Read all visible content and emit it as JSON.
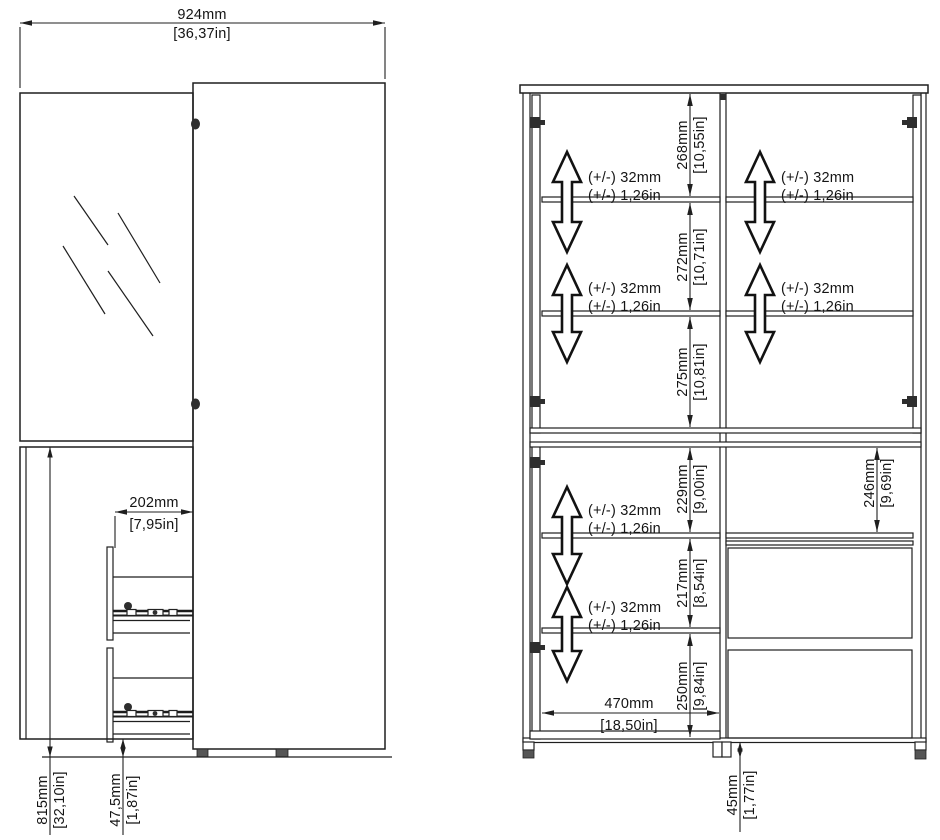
{
  "page": {
    "background": "#ffffff",
    "line_color": "#1f1f1f"
  },
  "front_view": {
    "width": {
      "mm": "924mm",
      "in": "[36,37in]"
    },
    "drawer_depth": {
      "mm": "202mm",
      "in": "[7,95in]"
    },
    "lower_section_height": {
      "mm": "815mm",
      "in": "[32,10in]"
    },
    "plinth_height": {
      "mm": "47,5mm",
      "in": "[1,87in]"
    }
  },
  "interior_view": {
    "section_heights": [
      {
        "mm": "268mm",
        "in": "[10,55in]"
      },
      {
        "mm": "272mm",
        "in": "[10,71in]"
      },
      {
        "mm": "275mm",
        "in": "[10,81in]"
      },
      {
        "mm": "229mm",
        "in": "[9,00in]"
      },
      {
        "mm": "217mm",
        "in": "[8,54in]"
      },
      {
        "mm": "250mm",
        "in": "[9,84in]"
      }
    ],
    "right_section_height": {
      "mm": "246mm",
      "in": "[9,69in]"
    },
    "interior_width": {
      "mm": "470mm",
      "in": "[18,50in]"
    },
    "foot_height": {
      "mm": "45mm",
      "in": "[1,77in]"
    },
    "shelf_adjustment": {
      "mm": "(+/-) 32mm",
      "in": "(+/-) 1,26in"
    }
  }
}
